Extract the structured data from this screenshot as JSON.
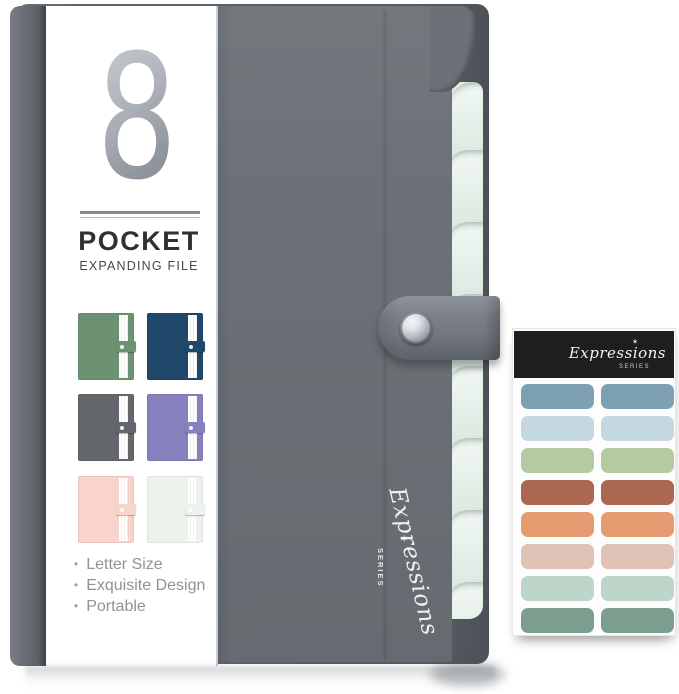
{
  "brand": {
    "script": "Expressions",
    "series": "SERIES",
    "star": "✶"
  },
  "logo": {
    "number": "8",
    "title": "POCKET",
    "subtitle": "EXPANDING FILE"
  },
  "features": {
    "items": [
      "Letter Size",
      "Exquisite Design",
      "Portable"
    ]
  },
  "swatches": [
    {
      "name": "green",
      "color": "#6d9173"
    },
    {
      "name": "navy",
      "color": "#1f486b"
    },
    {
      "name": "gray",
      "color": "#64686d"
    },
    {
      "name": "purple",
      "color": "#8781bd"
    },
    {
      "name": "pink",
      "color": "#f8d4cc"
    },
    {
      "name": "white",
      "color": "#edf2ed"
    }
  ],
  "folder": {
    "cover_color": "#6c7177",
    "spine_color": "#6a6f76",
    "back_color": "#5d626a",
    "pages_color": "#dfeae3",
    "strap_color": "#767c84",
    "snap_color": "#c9ced3"
  },
  "sticker_sheet": {
    "header_bg": "#1d1e20",
    "row_colors": [
      "#7da1b2",
      "#c5d8e2",
      "#b6caa2",
      "#ab6752",
      "#e69b71",
      "#e0c1b6",
      "#bed6ca",
      "#7c9e8f"
    ]
  }
}
